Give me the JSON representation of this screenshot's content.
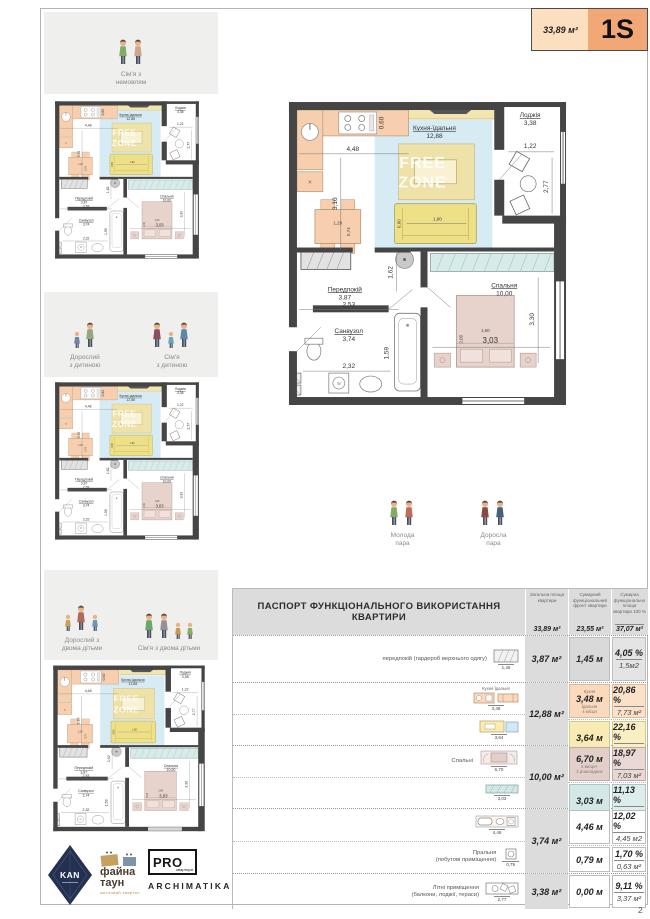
{
  "page": {
    "number": "2"
  },
  "header": {
    "area": "33,89 м²",
    "type": "1S"
  },
  "personas": {
    "family_baby": "Сім'я з\nнемовлям",
    "adult_child": "Дорослий\nз дитиною",
    "family_child": "Сім'я\nз дитиною",
    "adult_two_children": "Дорослий з\nдвома дітьми",
    "family_two_children": "Сім'я з двома дітьми",
    "young_couple": "Молода\nпара",
    "adult_couple": "Доросла\nпара"
  },
  "floorplan": {
    "watermark_line1": "FREE",
    "watermark_line2": "ZONE",
    "rooms": {
      "kitchen": {
        "name": "Кухня-їдальня",
        "area": "12,88"
      },
      "loggia": {
        "name": "Лоджія",
        "area": "3,38"
      },
      "hall": {
        "name": "Передпокій",
        "area": "3,87"
      },
      "bath": {
        "name": "Санвузол",
        "area": "3,74"
      },
      "bedroom": {
        "name": "Спальня",
        "area": "10,00"
      }
    },
    "dims": {
      "d448": "4,48",
      "d310": "3,10",
      "d060a": "0,60",
      "d122": "1,22",
      "d277": "2,77",
      "d129": "1,29",
      "d074": "0,74",
      "d180": "1,80",
      "d060b": "0,60",
      "d162": "1,62",
      "d253": "2,53",
      "d232": "2,32",
      "d159": "1,59",
      "d330": "3,30",
      "d303": "3,03",
      "d160": "1,60",
      "d200": "2,00"
    }
  },
  "table": {
    "title": "ПАСПОРТ ФУНКЦІОНАЛЬНОГО ВИКОРИСТАННЯ КВАРТИРИ",
    "col_total": {
      "header": "Загальна площа квартири",
      "value": "33,89 м²"
    },
    "col_front": {
      "header": "Сумарний функціональний фронт квартири",
      "value": "23,55 м²"
    },
    "col_func": {
      "header": "Сумарна функціонально площа квартири 100 %",
      "value": "37,07 м²"
    },
    "rows": [
      {
        "caption": "передпокій (гардероб верхнього одягу)",
        "icon_dim": "1,45",
        "area": "3,87 м²",
        "subs": [
          {
            "front": "1,45 м",
            "pct": "4,05 %",
            "farea": "1,5м2"
          }
        ]
      },
      {
        "area": "12,88 м²",
        "subs": [
          {
            "front": "3,48 м",
            "front_top": "Кухня",
            "front_note": "Їдальня\n4 місця",
            "icon_labels": "Кухня   Їдальня",
            "icon_dim": "3,48",
            "pct": "20,86 %",
            "farea": "7,73 м²"
          },
          {
            "front": "3,64 м",
            "icon_dim": "3,64",
            "pct": "22,16 %",
            "farea": "8,21 м²"
          }
        ]
      },
      {
        "caption": "Спальні",
        "area": "10,00 м²",
        "subs": [
          {
            "front": "6,70 м",
            "front_note": "2 місця+\n2 розкладних",
            "icon_dim": "6,70",
            "pct": "18,97 %",
            "farea": "7,03 м²"
          },
          {
            "front": "3,03 м",
            "icon_dim": "3,03",
            "pct": "11,13 %",
            "farea": "4,12 м²"
          }
        ]
      },
      {
        "area": "3,74 м²",
        "subs": [
          {
            "front": "4,46 м",
            "icon_dim": "4,46",
            "pct": "12,02 %",
            "farea": "4,45 м2"
          },
          {
            "front": "0,79 м",
            "caption": "Пральня\n(побутові приміщення)",
            "icon_dim": "0,79",
            "pct": "1,70 %",
            "farea": "0,63 м²"
          }
        ]
      },
      {
        "caption": "Літні приміщення\n(балкони, лоджії, тераси)",
        "icon_dim": "2,77",
        "area": "3,38 м²",
        "subs": [
          {
            "front": "0,00 м",
            "pct": "9,11 %",
            "farea": "3,37 м²"
          }
        ]
      }
    ]
  },
  "logos": {
    "kan": "KAN",
    "fayna_line1": "файна",
    "fayna_line2": "таун",
    "fayna_sub": "житловий квартал",
    "pro": "PRO",
    "pro_sub": "квартири",
    "archimatika": "ARCHIMATIKA"
  }
}
